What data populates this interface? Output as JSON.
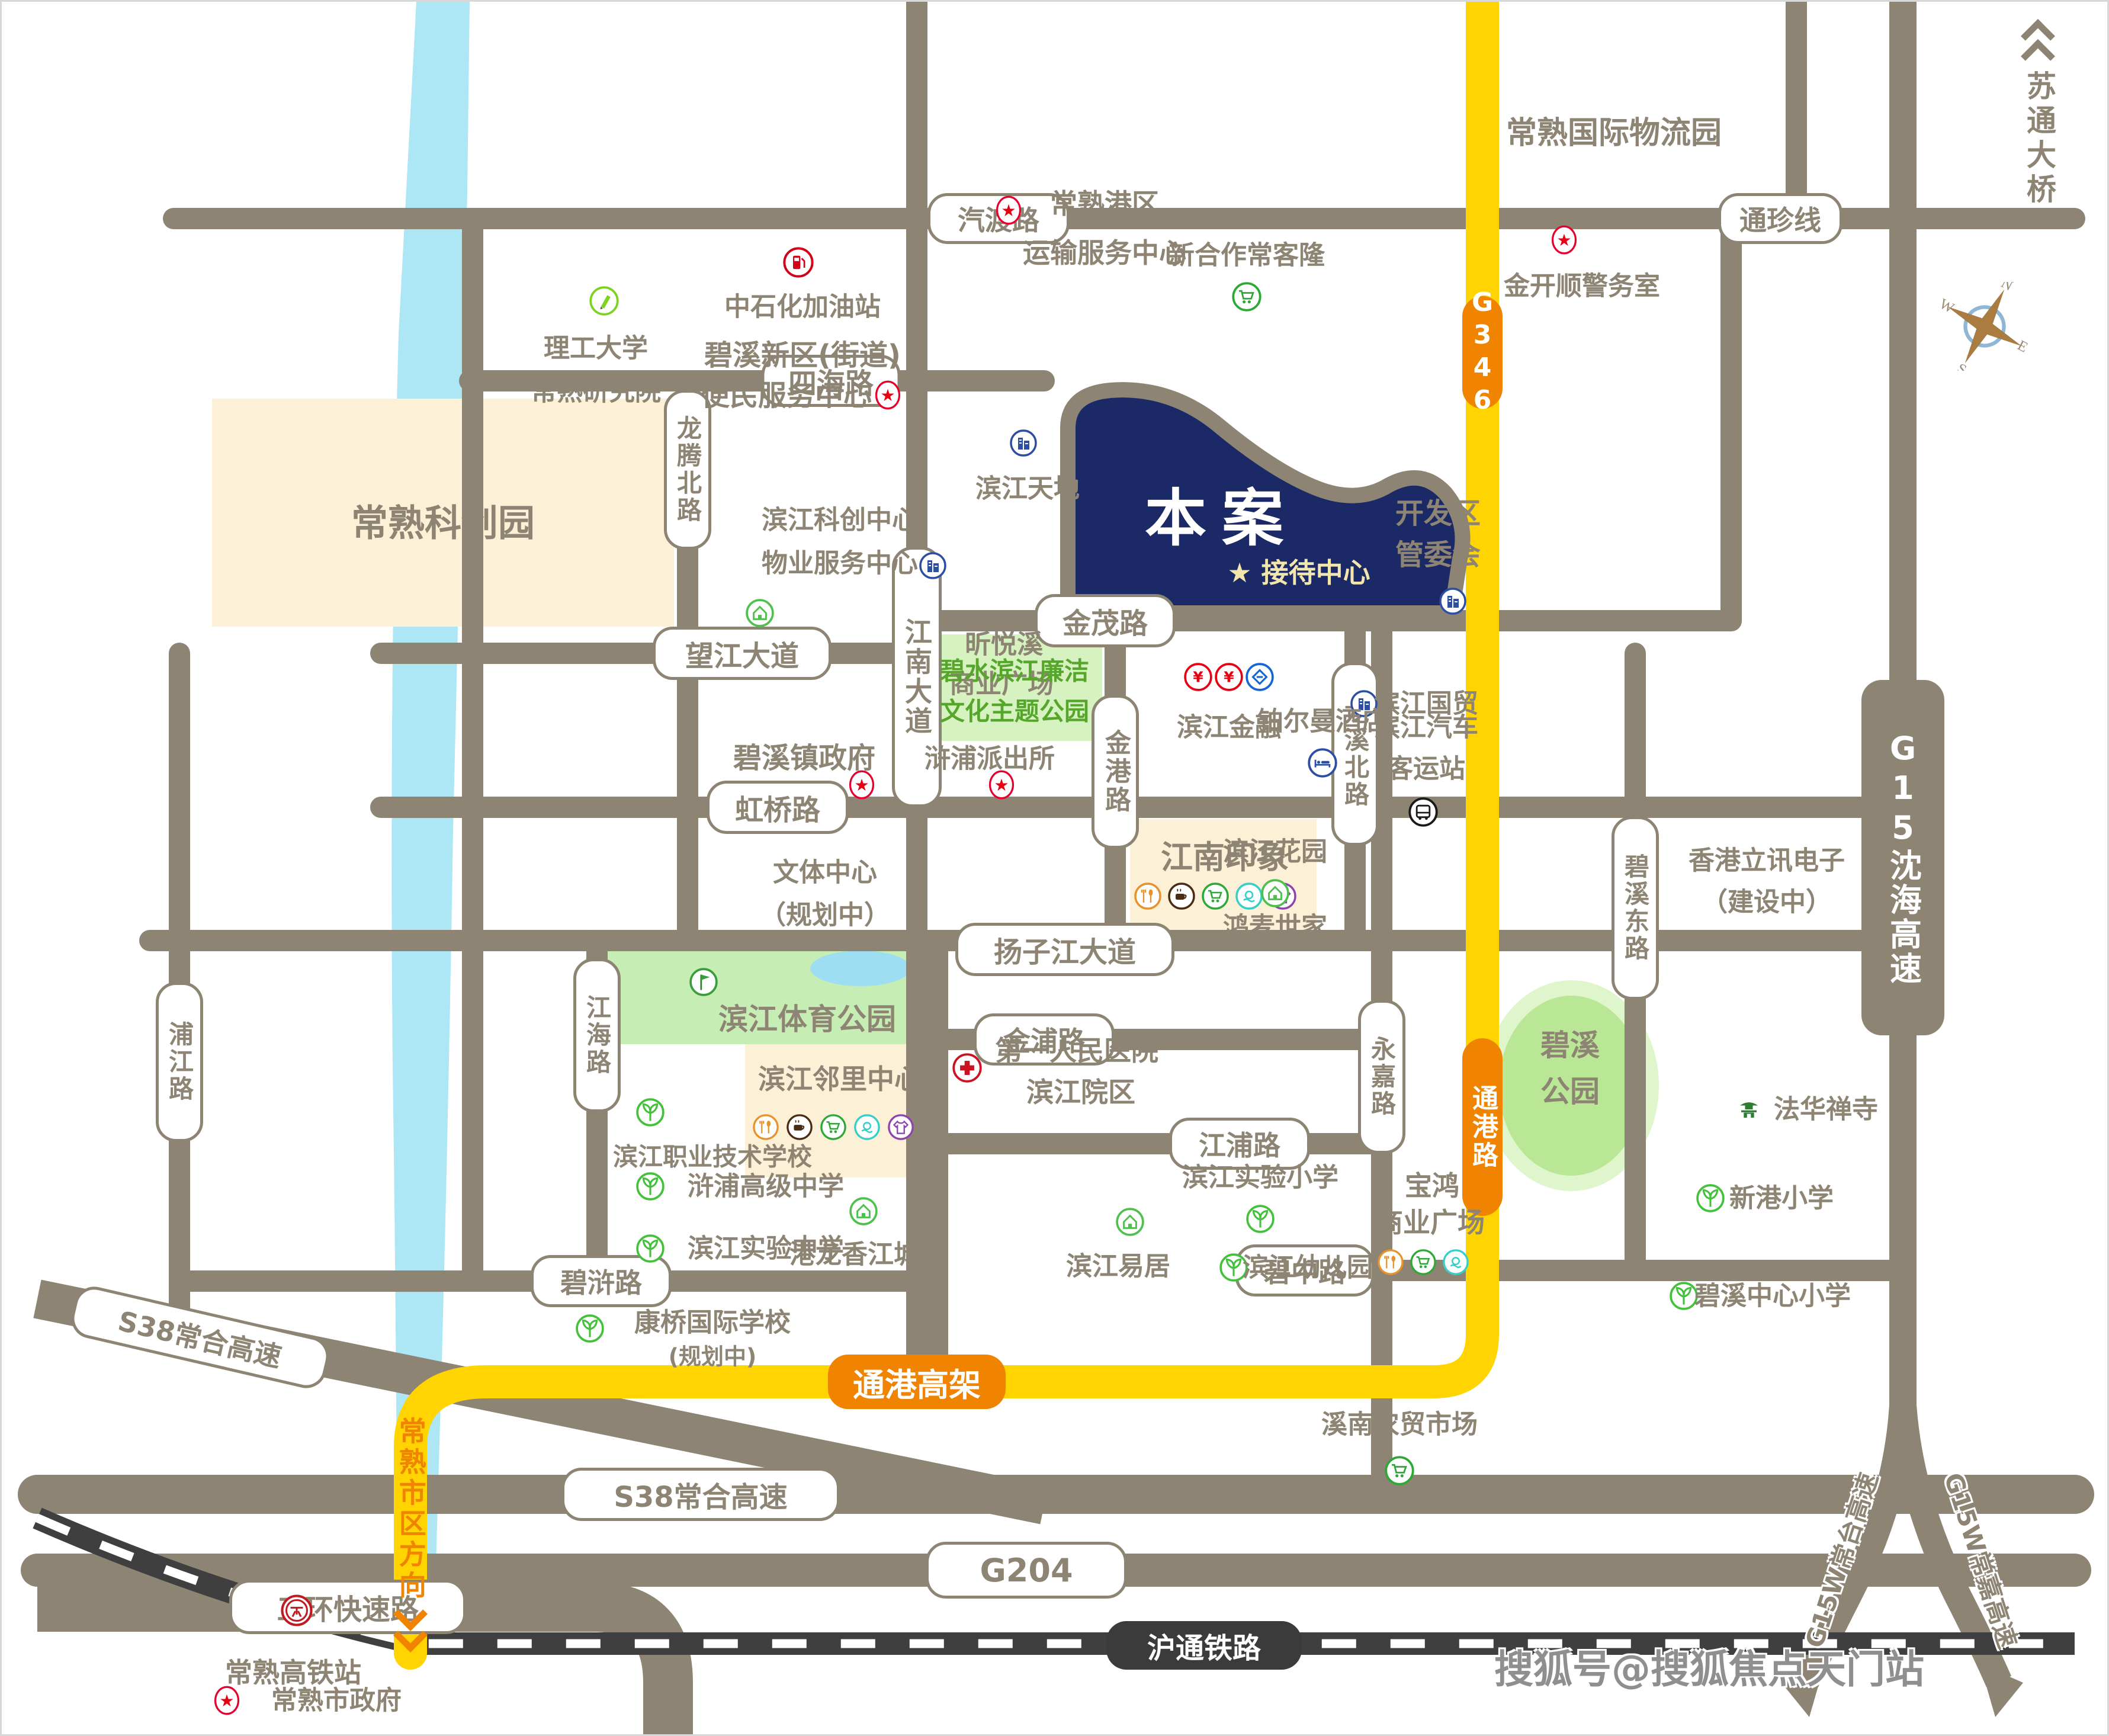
{
  "watermark": "搜狐号@搜狐焦点天门站",
  "project": {
    "name": "本案",
    "reception_star": "★",
    "reception": "接待中心"
  },
  "compass": {
    "n": "N",
    "e": "E",
    "s": "S",
    "w": "W"
  },
  "bridge_exit": "苏通大桥",
  "direction_note": "常熟市区方向",
  "colors": {
    "road": "#8d8474",
    "yellow_road": "#ffd400",
    "orange": "#f08300",
    "navy_project": "#1b2a66",
    "river": "#ade6f4",
    "cream_block": "#fcf1d6",
    "green_block": "#d6f2c0",
    "park_green": "#c6edb4",
    "railway": "#3f3f3f",
    "reception_text": "#f2e6ad",
    "green_text": "#56a62b"
  },
  "roads": {
    "qidu": "汽渡路",
    "tongzhen": "通珍线",
    "sihai": "四海路",
    "jinmao": "金茂路",
    "wangjiang": "望江大道",
    "hongqiao": "虹桥路",
    "yangzi": "扬子江大道",
    "jinpu": "金浦路",
    "jiangpu": "江浦路",
    "bihu": "碧浒路",
    "bizhong": "碧中路",
    "sanhuan": "三环快速路",
    "s38": "S38常合高速",
    "g204": "G204",
    "longteng": "龙腾北路",
    "jiangnan": "江南大道",
    "jingang": "金港路",
    "longxi": "龙溪北路",
    "yongjia": "永嘉路",
    "bixidong": "碧溪东路",
    "jianghai": "江海路",
    "pujiang": "浦江路",
    "hutong": "沪通铁路",
    "g15": "G15沈海高速",
    "g346": "G346",
    "tonggang_lu": "通港路",
    "tonggang_gaojia": "通港高架",
    "g15w_changtai": "G15W常台高速",
    "g15w_changjia": "G15W常嘉高速"
  },
  "landmarks": {
    "gangqu": {
      "lines": [
        "常熟港区",
        "运输服务中心"
      ],
      "icon": "red-star-icon"
    },
    "xinhezuo": {
      "lines": [
        "新合作常客隆"
      ],
      "icon": "cart-icon"
    },
    "wuliuyuan": {
      "lines": [
        "常熟国际物流园"
      ],
      "icon": null
    },
    "jinkaishun": {
      "lines": [
        "金开顺警务室"
      ],
      "icon": "red-star-icon"
    },
    "ligong": {
      "lines": [
        "理工大学",
        "常熟研究院"
      ],
      "icon": "pencil-icon"
    },
    "zhongshihua": {
      "lines": [
        "中石化加油站"
      ],
      "icon": "gas-pump-icon"
    },
    "bianmin": {
      "lines": [
        "碧溪新区(街道)",
        "便民服务中心"
      ],
      "icon": "red-star-icon"
    },
    "kechuangyuan": {
      "lines": [
        "常熟科创园"
      ],
      "icon": null
    },
    "bkwuye": {
      "lines": [
        "滨江科创中心",
        "物业服务中心"
      ],
      "icon": "building-icon"
    },
    "house1": {
      "lines": [],
      "icon": "house-icon"
    },
    "bjtiandi": {
      "lines": [
        "滨江天地"
      ],
      "icon": "building-icon"
    },
    "kaifaqu": {
      "lines": [
        "开发区",
        "管委会"
      ],
      "icon": "building-icon"
    },
    "xinyuexi": {
      "lines": [
        "昕悦溪",
        "商业广场"
      ],
      "icon": null
    },
    "bjjinrong": {
      "lines": [
        "滨江金融"
      ],
      "icon": "bank-icons"
    },
    "bjguomao": {
      "lines": [
        "滨江国贸"
      ],
      "icon": "building-icon"
    },
    "bishui": {
      "lines": [
        "碧水滨江廉洁",
        "文化主题公园"
      ],
      "icon": null
    },
    "hupupcs": {
      "lines": [
        "浒浦派出所"
      ],
      "icon": "red-star-icon"
    },
    "bixigov": {
      "lines": [
        "碧溪镇政府"
      ],
      "icon": "red-star-icon"
    },
    "wenti": {
      "lines": [
        "文体中心",
        "（规划中）"
      ],
      "icon": null
    },
    "jnyinxiang": {
      "lines": [
        "江南印象"
      ],
      "icon": "amenity-icons"
    },
    "boerman": {
      "lines": [
        "铂尔曼酒店"
      ],
      "icon": "hotel-bed-icon"
    },
    "bjkeyun": {
      "lines": [
        "滨江汽车",
        "客运站"
      ],
      "icon": "bus-icon"
    },
    "bjhuayuan": {
      "lines": [
        "滨江花园"
      ],
      "icon": "house-icon"
    },
    "hongmai": {
      "lines": [
        "鸿麦世家"
      ],
      "icon": null
    },
    "sportpark": {
      "lines": [
        "滨江体育公园"
      ],
      "icon": "flag-icon"
    },
    "bjzhiye": {
      "lines": [
        "滨江职业技术学校"
      ],
      "icon": "school-sprout-icon"
    },
    "bjlinli": {
      "lines": [
        "滨江邻里中心"
      ],
      "icon": "amenity-icons"
    },
    "hospital": {
      "lines": [
        "第一人民医院",
        "滨江院区"
      ],
      "icon": "red-cross-icon"
    },
    "hupugaozhong": {
      "lines": [
        "浒浦高级中学"
      ],
      "icon": "school-sprout-icon"
    },
    "bjshiyanzhong": {
      "lines": [
        "滨江实验中学"
      ],
      "icon": "school-sprout-icon"
    },
    "ganglong": {
      "lines": [
        "港龙香江城"
      ],
      "icon": "house-icon"
    },
    "bjyiju": {
      "lines": [
        "滨江易居"
      ],
      "icon": "house-icon"
    },
    "bjshiyanxiao": {
      "lines": [
        "滨江实验小学"
      ],
      "icon": "school-sprout-icon"
    },
    "bjyoueryuan": {
      "lines": [
        "滨江幼儿园"
      ],
      "icon": "school-sprout-icon"
    },
    "baohong": {
      "lines": [
        "宝鸿",
        "商业广场"
      ],
      "icon": "amenity-icons"
    },
    "xingangxiao": {
      "lines": [
        "新港小学"
      ],
      "icon": "school-sprout-icon"
    },
    "bixizhongxin": {
      "lines": [
        "碧溪中心小学"
      ],
      "icon": "school-sprout-icon"
    },
    "xinanmarket": {
      "lines": [
        "溪南农贸市场"
      ],
      "icon": "cart-icon"
    },
    "kangqiao": {
      "lines": [
        "康桥国际学校",
        "(规划中)"
      ],
      "icon": "school-sprout-icon"
    },
    "bixipark": {
      "lines": [
        "碧溪",
        "公园"
      ],
      "icon": null
    },
    "fahua": {
      "lines": [
        "法华禅寺"
      ],
      "icon": "temple-icon"
    },
    "lixun": {
      "lines": [
        "香港立讯电子",
        "（建设中）"
      ],
      "icon": null
    },
    "gaotie": {
      "lines": [
        "常熟高铁站"
      ],
      "icon": "railway-station-icon"
    },
    "shizhengfu": {
      "lines": [
        "常熟市政府"
      ],
      "icon": "red-star-icon"
    }
  }
}
